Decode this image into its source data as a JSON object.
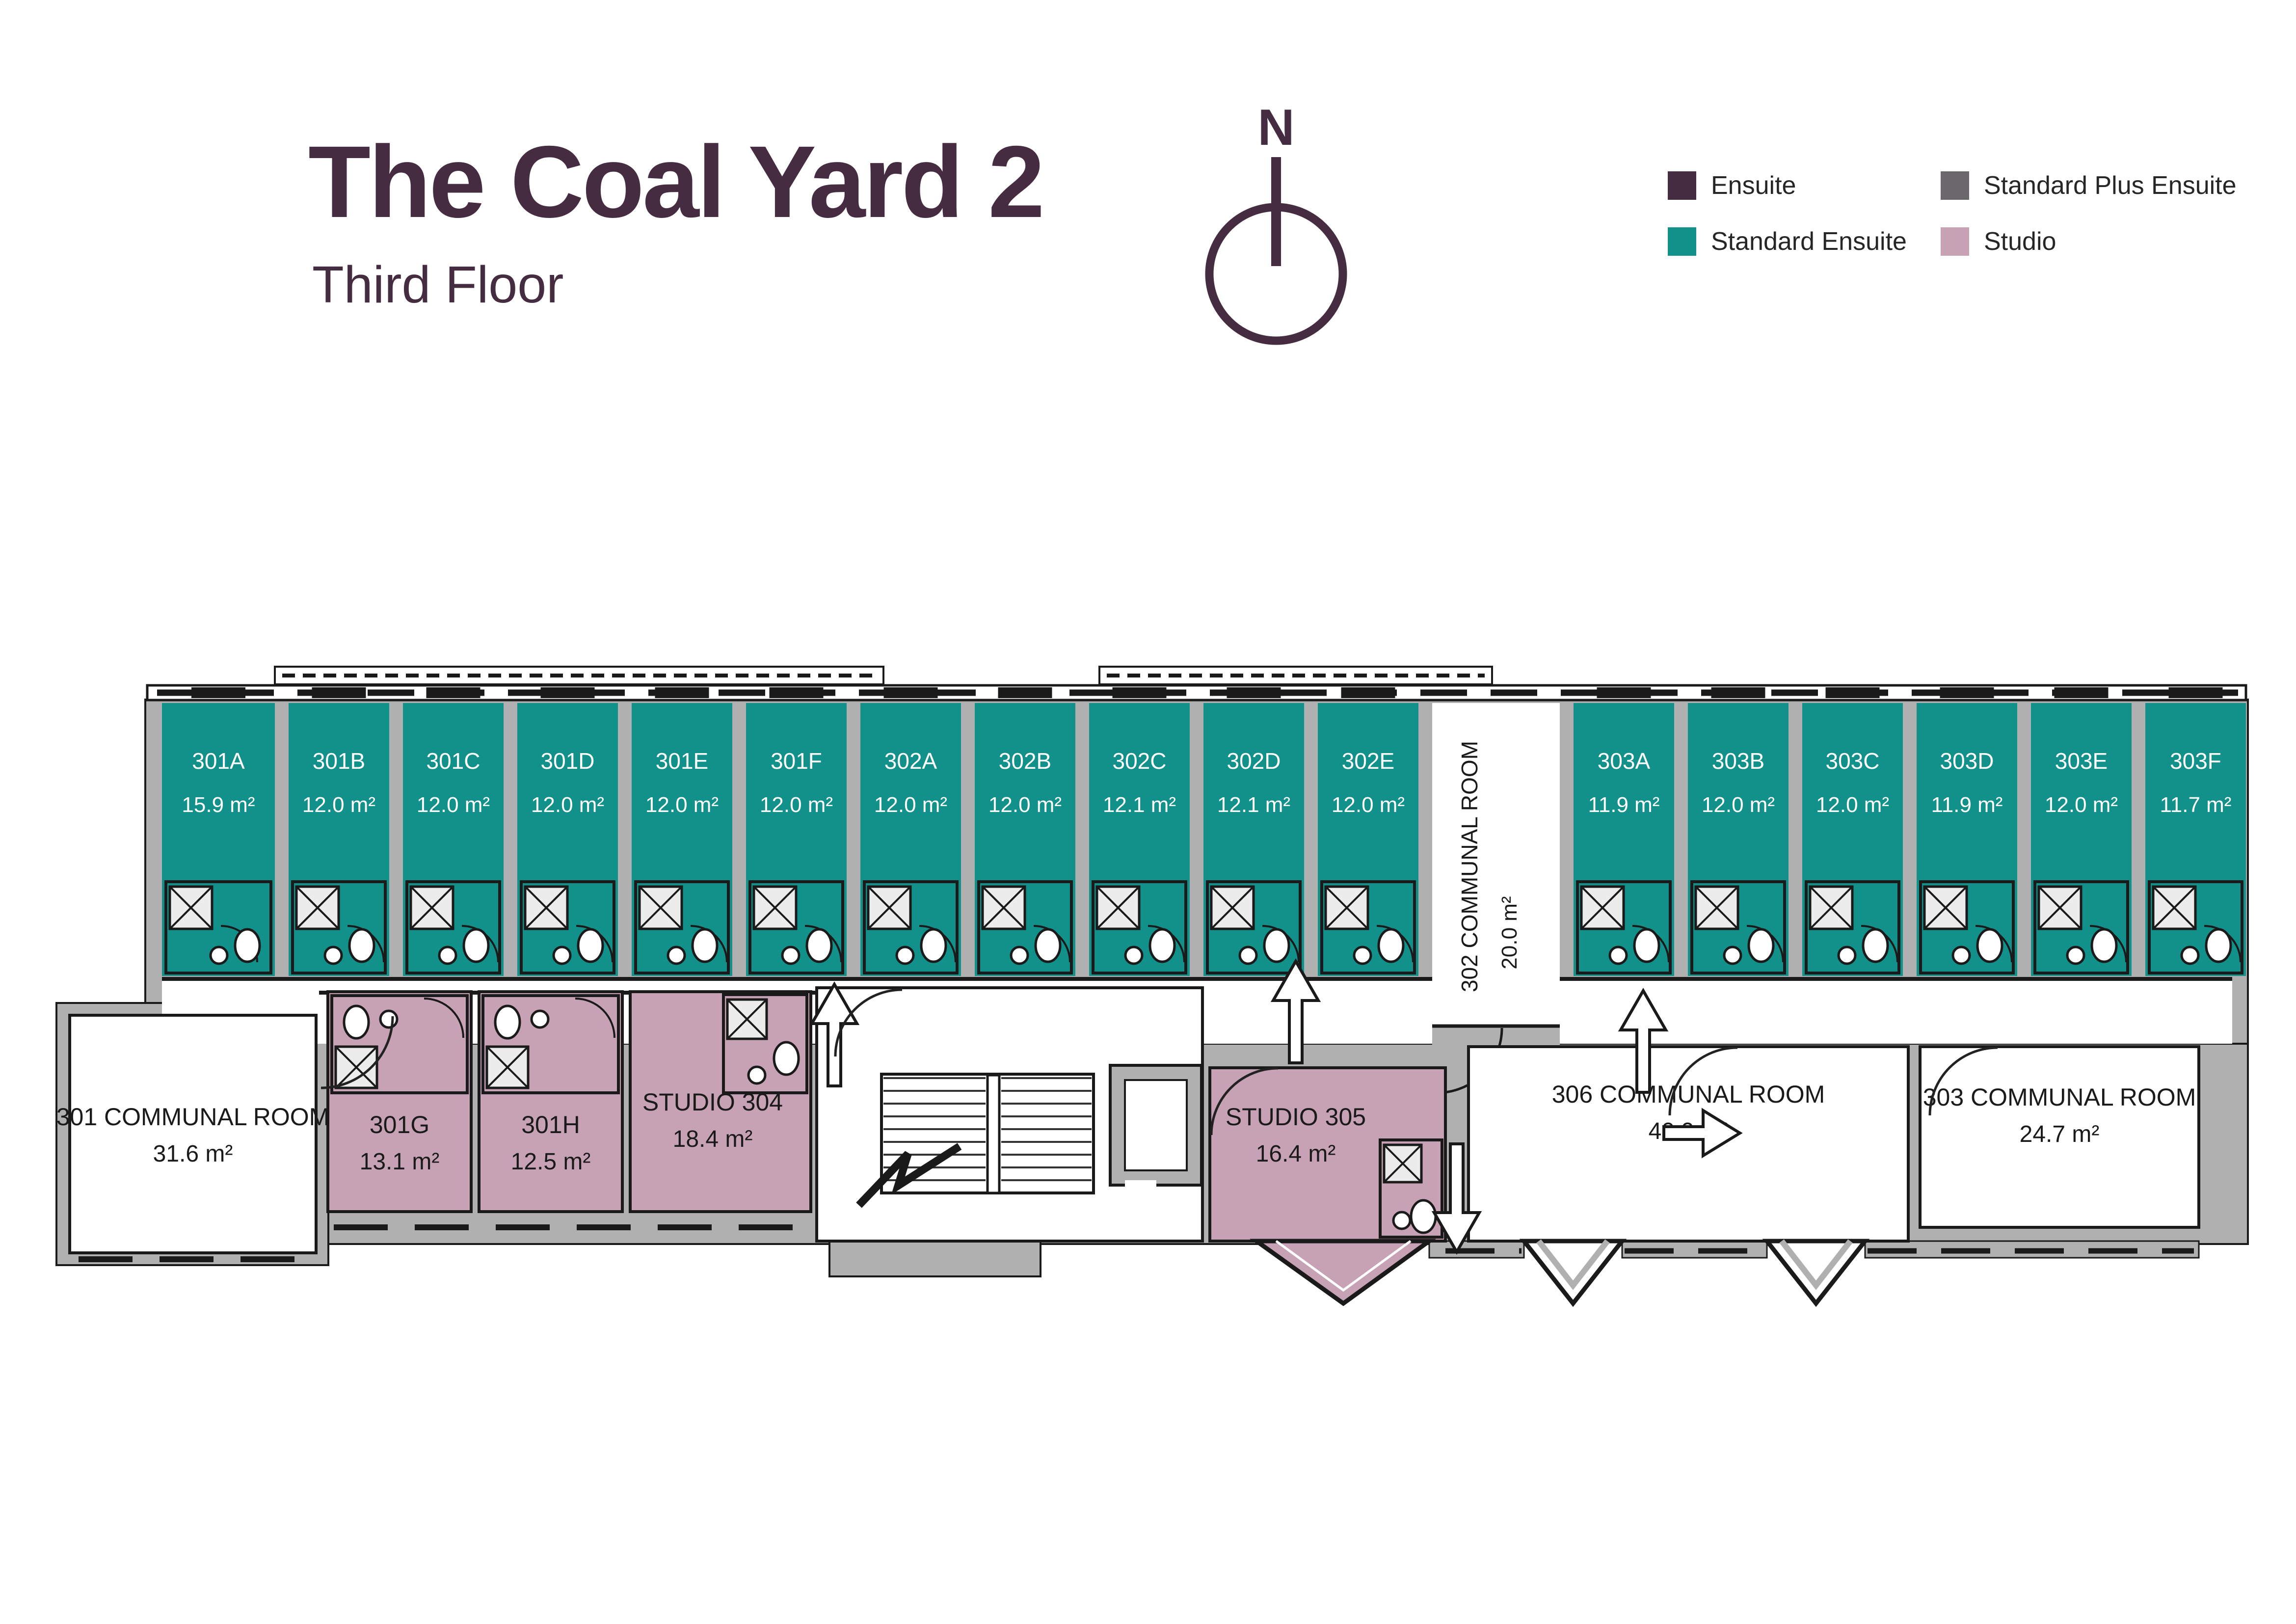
{
  "title": "The Coal Yard 2",
  "subtitle": "Third Floor",
  "compass": {
    "label": "N"
  },
  "legend": {
    "items": [
      {
        "label": "Ensuite",
        "color": "#452C40"
      },
      {
        "label": "Standard Plus Ensuite",
        "color": "#6B686B"
      },
      {
        "label": "Standard Ensuite",
        "color": "#12908A"
      },
      {
        "label": "Studio",
        "color": "#C7A2B4"
      }
    ]
  },
  "floorplan": {
    "top_row": [
      {
        "id": "301A",
        "area": "15.9 m²",
        "type": "standard-ensuite"
      },
      {
        "id": "301B",
        "area": "12.0 m²",
        "type": "standard-ensuite"
      },
      {
        "id": "301C",
        "area": "12.0 m²",
        "type": "standard-ensuite"
      },
      {
        "id": "301D",
        "area": "12.0 m²",
        "type": "standard-ensuite"
      },
      {
        "id": "301E",
        "area": "12.0 m²",
        "type": "standard-ensuite"
      },
      {
        "id": "301F",
        "area": "12.0 m²",
        "type": "standard-ensuite"
      },
      {
        "id": "302A",
        "area": "12.0 m²",
        "type": "standard-ensuite"
      },
      {
        "id": "302B",
        "area": "12.0 m²",
        "type": "standard-ensuite"
      },
      {
        "id": "302C",
        "area": "12.1 m²",
        "type": "standard-ensuite"
      },
      {
        "id": "302D",
        "area": "12.1 m²",
        "type": "standard-ensuite"
      },
      {
        "id": "302E",
        "area": "12.0 m²",
        "type": "standard-ensuite"
      },
      {
        "id": "302 COMMUNAL ROOM",
        "area": "20.0 m²",
        "type": "communal"
      },
      {
        "id": "303A",
        "area": "11.9 m²",
        "type": "standard-ensuite"
      },
      {
        "id": "303B",
        "area": "12.0 m²",
        "type": "standard-ensuite"
      },
      {
        "id": "303C",
        "area": "12.0 m²",
        "type": "standard-ensuite"
      },
      {
        "id": "303D",
        "area": "11.9 m²",
        "type": "standard-ensuite"
      },
      {
        "id": "303E",
        "area": "12.0 m²",
        "type": "standard-ensuite"
      },
      {
        "id": "303F",
        "area": "11.7 m²",
        "type": "standard-ensuite"
      }
    ],
    "bottom_row": [
      {
        "id": "301 COMMUNAL ROOM",
        "area": "31.6 m²",
        "type": "communal"
      },
      {
        "id": "301G",
        "area": "13.1 m²",
        "type": "studio"
      },
      {
        "id": "301H",
        "area": "12.5 m²",
        "type": "studio"
      },
      {
        "id": "STUDIO 304",
        "area": "18.4 m²",
        "type": "studio"
      },
      {
        "id": "STUDIO 305",
        "area": "16.4 m²",
        "type": "studio"
      },
      {
        "id": "306 COMMUNAL ROOM",
        "area": "40.9 m²",
        "type": "communal"
      },
      {
        "id": "303 COMMUNAL ROOM",
        "area": "24.7 m²",
        "type": "communal"
      }
    ]
  },
  "colors": {
    "ensuite": "#452C40",
    "standard_plus_ensuite": "#6B686B",
    "standard_ensuite": "#12908A",
    "studio": "#C7A2B4",
    "wall": "#B1B0B1",
    "line": "#1A1A1A",
    "room_text_light": "#FFFFFF",
    "room_text_dark": "#1A1A1A"
  }
}
